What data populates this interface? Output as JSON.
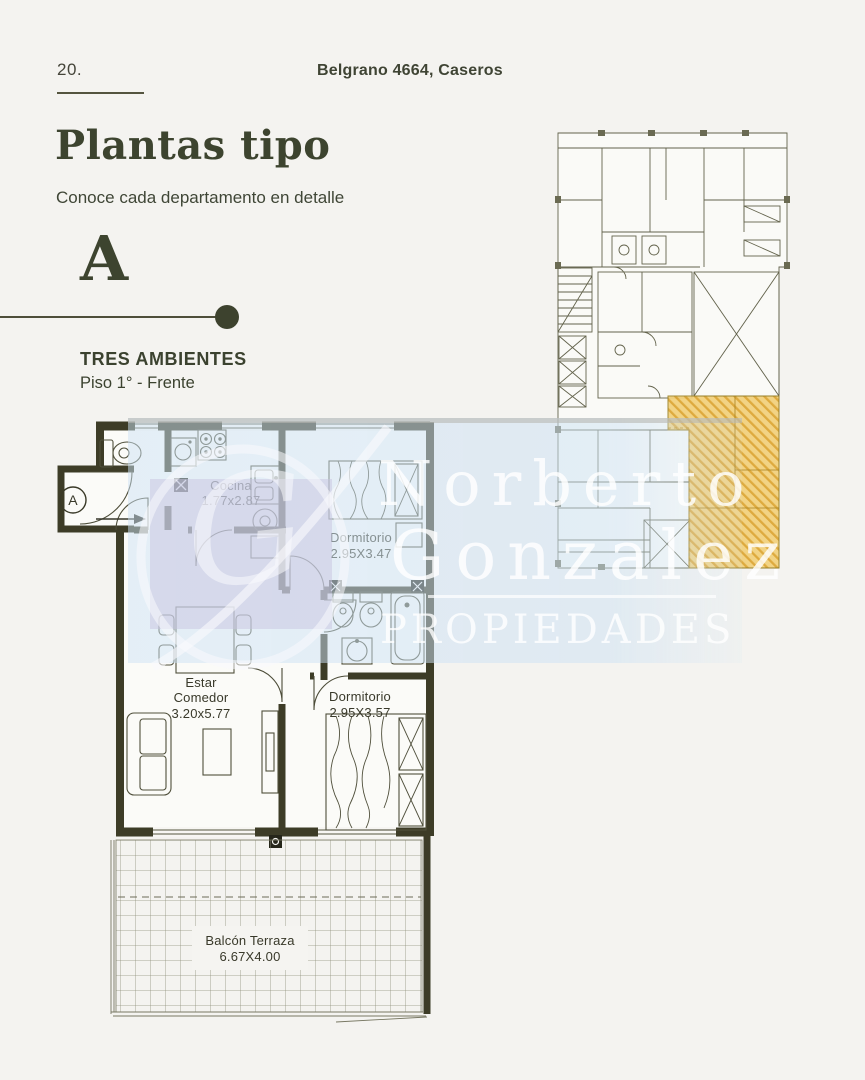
{
  "page": {
    "number": "20.",
    "address": "Belgrano 4664, Caseros",
    "title": "Plantas tipo",
    "subtitle": "Conoce cada departamento en detalle"
  },
  "unit": {
    "letter": "A",
    "type": "TRES AMBIENTES",
    "floor": "Piso 1° - Frente"
  },
  "floorplan": {
    "entrance_label": "A",
    "rooms": [
      {
        "id": "cocina",
        "label": "Cocina",
        "dims": "1.77x2.87"
      },
      {
        "id": "dormitorio-1",
        "label": "Dormitorio",
        "dims": "2.95X3.47"
      },
      {
        "id": "estar-comedor",
        "label": "Estar",
        "label2": "Comedor",
        "dims": "3.20x5.77"
      },
      {
        "id": "dormitorio-2",
        "label": "Dormitorio",
        "dims": "2.95X3.57"
      },
      {
        "id": "balcon-terraza",
        "label": "Balcón Terraza",
        "dims": "6.67X4.00"
      }
    ]
  },
  "watermark": {
    "monogram": "G",
    "line1": "Norberto",
    "line2": "Gonzalez",
    "line3": "PROPIEDADES"
  },
  "colors": {
    "background": "#f4f3f0",
    "ink": "#3d422f",
    "wall": "#3d3c27",
    "plan_line": "#50503c",
    "highlight_fill": "#f2d07b",
    "highlight_hatch": "#dca42f",
    "watermark_tint": "#cde2f4",
    "watermark_text": "#ffffff"
  }
}
